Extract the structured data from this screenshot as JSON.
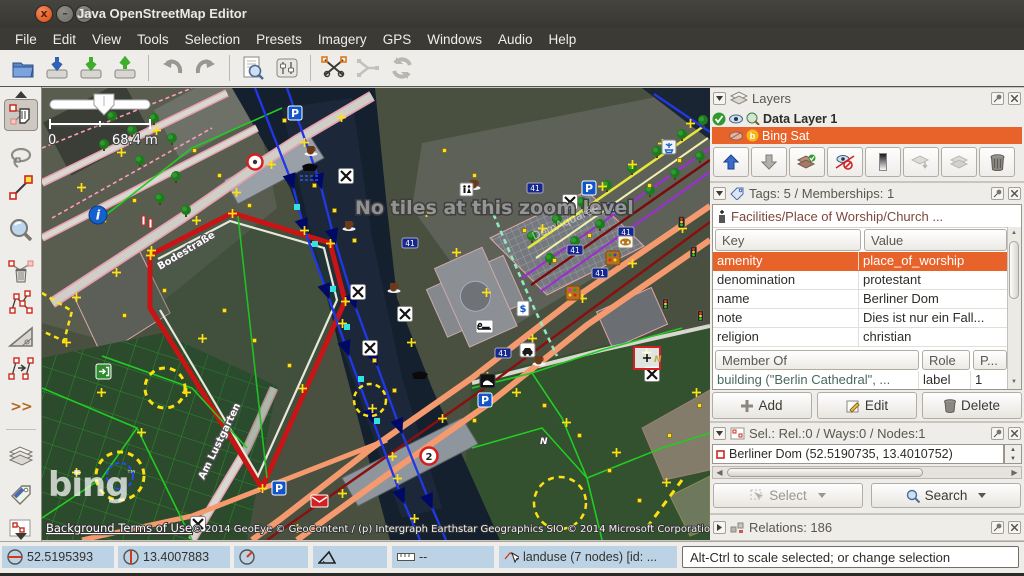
{
  "window": {
    "title": "Java OpenStreetMap Editor"
  },
  "menu": {
    "items": [
      "File",
      "Edit",
      "View",
      "Tools",
      "Selection",
      "Presets",
      "Imagery",
      "GPS",
      "Windows",
      "Audio",
      "Help"
    ]
  },
  "left_toolbar": {
    "more": ">>"
  },
  "map": {
    "no_tiles_text": "No tiles at this zoom level",
    "scale_zero": "0",
    "scale_label": "68.4 m",
    "bing_logo": "bing",
    "bing_tm": "™",
    "terms_link": "Background Terms of Use",
    "copyright": "© 2014 GeoEye © GeoContent / (p) Intergraph Earthstar Geographics SIO © 2014 Microsoft Corporation",
    "labels": {
      "bodestrasse": "Bodestraße",
      "am_lustgarten": "Am Lustgarten",
      "domaquaree": "DomAquarée",
      "house_number": "41",
      "parking": "P",
      "speed": "2",
      "n": "N"
    }
  },
  "layers_panel": {
    "title": "Layers",
    "rows": [
      {
        "name": "Data Layer 1"
      },
      {
        "name": "Bing Sat"
      }
    ]
  },
  "tags_panel": {
    "title": "Tags: 5 / Memberships: 1",
    "preset": "Facilities/Place of Worship/Church ...",
    "key_header": "Key",
    "value_header": "Value",
    "rows": [
      {
        "key": "amenity",
        "value": "place_of_worship"
      },
      {
        "key": "denomination",
        "value": "protestant"
      },
      {
        "key": "name",
        "value": "Berliner Dom"
      },
      {
        "key": "note",
        "value": "Dies ist nur ein Fall..."
      },
      {
        "key": "religion",
        "value": "christian"
      }
    ],
    "member_header": "Member Of",
    "role_header": "Role",
    "pos_header": "P...",
    "membership": {
      "member": "building (\"Berlin Cathedral\", ...",
      "role": "label",
      "pos": "1"
    },
    "buttons": {
      "add": "Add",
      "edit": "Edit",
      "delete": "Delete"
    }
  },
  "selection_panel": {
    "title": "Sel.: Rel.:0 / Ways:0 / Nodes:1",
    "item": "Berliner Dom (52.5190735, 13.4010752)",
    "select_button": "Select",
    "search_button": "Search"
  },
  "relations_panel": {
    "title": "Relations: 186"
  },
  "statusbar": {
    "lat": "52.5195393",
    "lon": "13.4007883",
    "dist": "--",
    "hover": "landuse (7 nodes) [id: ...",
    "help": "Alt-Ctrl to scale selected; or change selection"
  }
}
